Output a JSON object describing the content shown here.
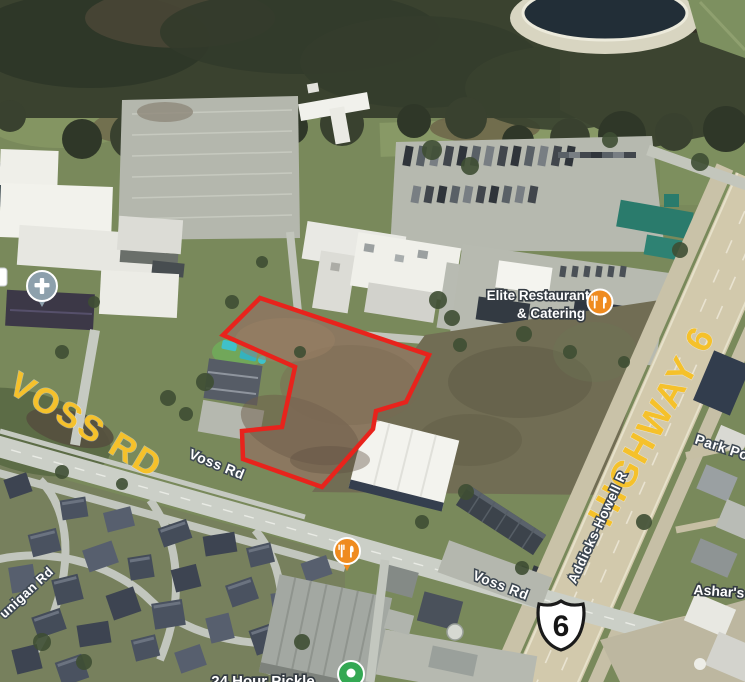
{
  "map": {
    "road_labels": {
      "voss_big": "VOSS RD",
      "highway_big": "HIGHWAY 6",
      "voss_small_1": "Voss Rd",
      "voss_small_2": "Voss Rd",
      "addicks_howell": "Addicks-Howell R",
      "park_po": "Park Po",
      "dunigan_partial": "unigan Rd"
    },
    "poi": {
      "elite_line1": "Elite Restaurant",
      "elite_line2": "& Catering",
      "ashars": "Ashar's",
      "pickle_partial": "24 Hour Pickle"
    },
    "shield": {
      "route_number": "6"
    },
    "icons": [
      {
        "name": "restaurant-pin-elite",
        "glyph": "fork-knife",
        "color": "#EF8B1F"
      },
      {
        "name": "restaurant-pin-voss",
        "glyph": "fork-knife",
        "color": "#EF8B1F"
      },
      {
        "name": "church-pin",
        "glyph": "latin-cross",
        "color": "#8DA0AC"
      },
      {
        "name": "green-poi-pin",
        "glyph": "partial",
        "color": "#34A853"
      }
    ],
    "colors": {
      "label_yellow": "#F5C12B",
      "label_white": "#FFFFFF",
      "label_halo": "#3E4852",
      "parcel_outline_red": "#E8231C",
      "highway_surface": "#D2C9AC",
      "water": "#222E37",
      "shield_fill": "#FFFFFF",
      "shield_border": "#1A1A1A"
    }
  }
}
